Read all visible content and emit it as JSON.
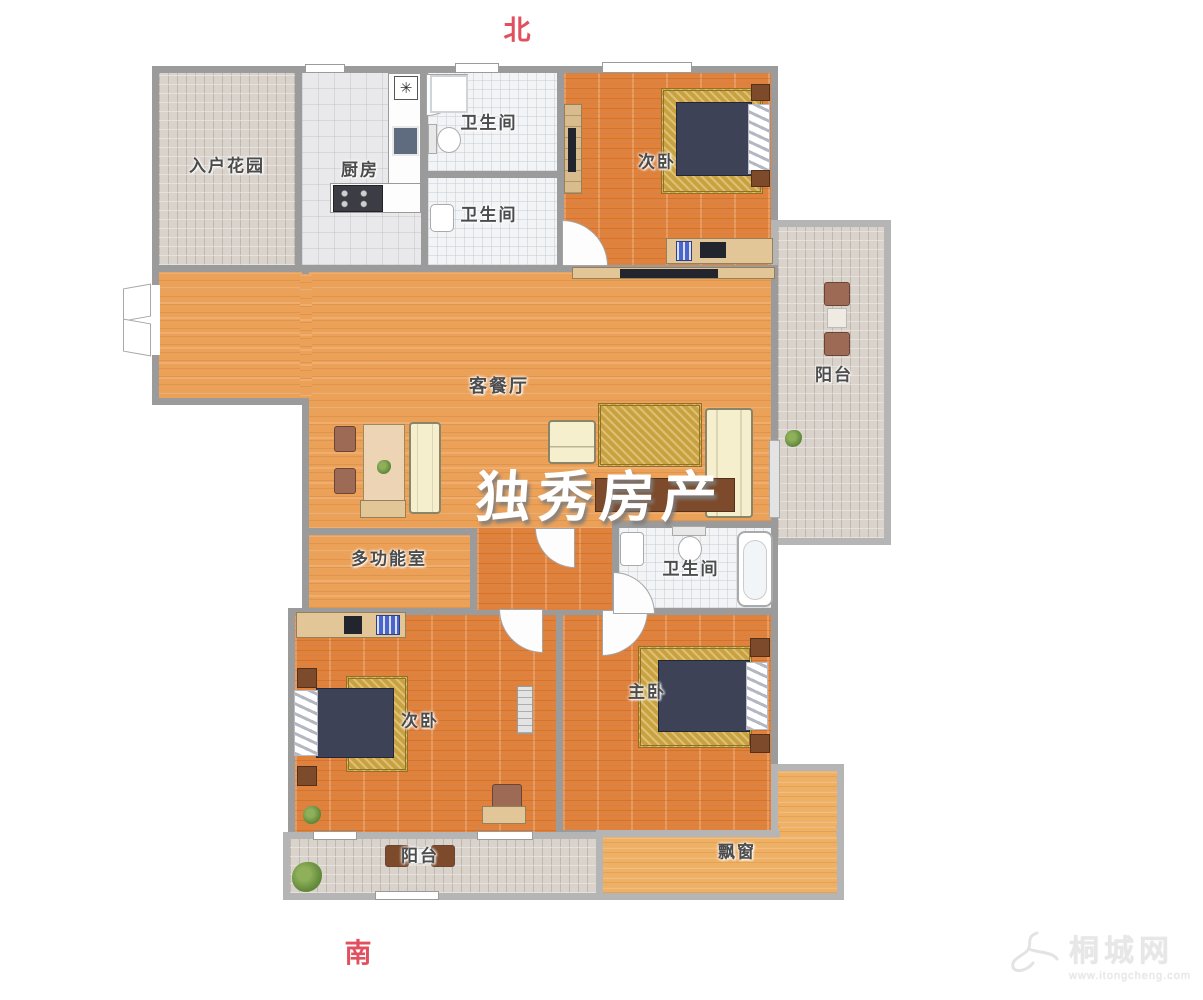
{
  "compass": {
    "north": "北",
    "south": "南"
  },
  "watermark": "独秀房产",
  "logo": {
    "site_name": "桐城网",
    "url": "www.itongcheng.com"
  },
  "rooms": {
    "entry_garden": "入户花园",
    "kitchen": "厨房",
    "bath_north_1": "卫生间",
    "bath_north_2": "卫生间",
    "bedroom_ne": "次卧",
    "balcony_east": "阳台",
    "living_dining": "客餐厅",
    "multi_function": "多功能室",
    "bath_master": "卫生间",
    "bedroom_sw": "次卧",
    "bedroom_master": "主卧",
    "balcony_south": "阳台",
    "bay_window": "飘窗"
  },
  "icons": {
    "appliance_star": "✳"
  },
  "colors": {
    "wall": "#9b9b9b",
    "compass_red": "#e0505e",
    "wood_dark": "#e0813c",
    "wood_living": "#eca159",
    "tile": "#dad3cc",
    "rug_gold": "#c9a23f",
    "bed_navy": "#3d4257"
  }
}
